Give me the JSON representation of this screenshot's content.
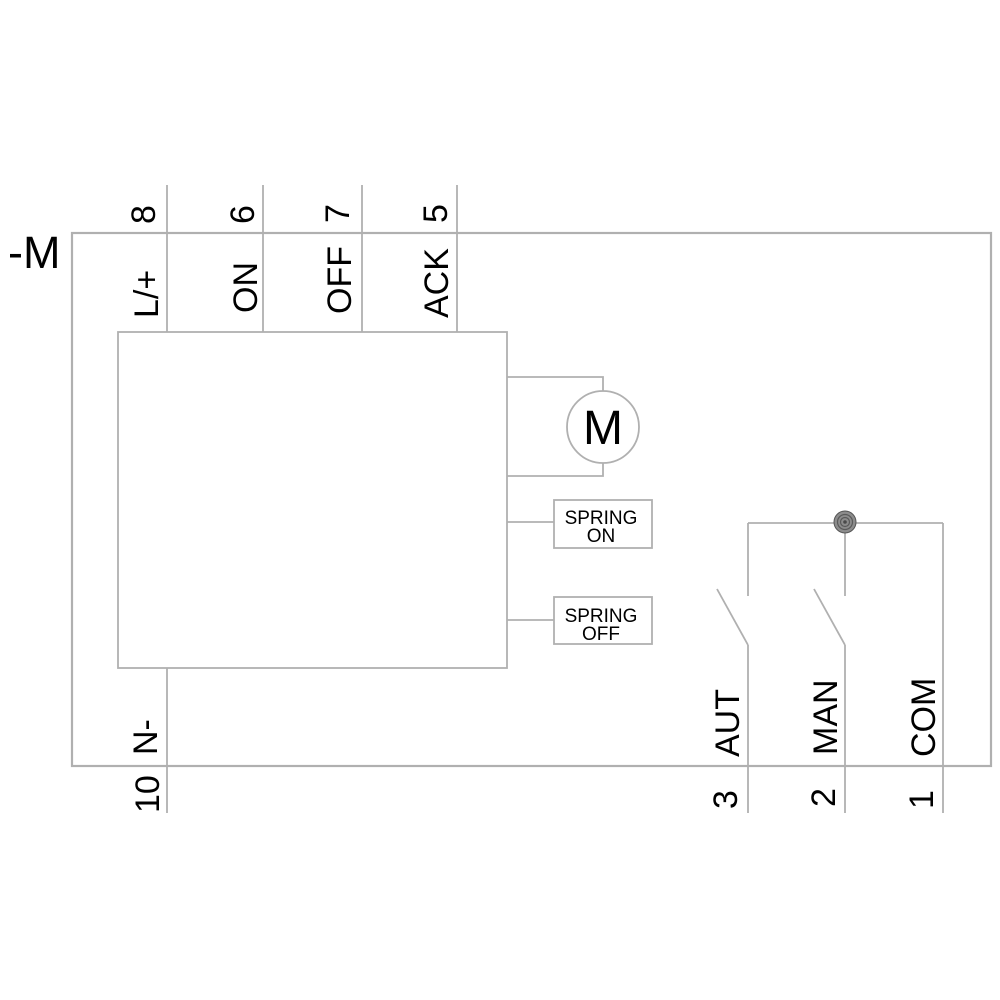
{
  "device_label": "-M",
  "motor": {
    "label": "M"
  },
  "top_terminals": [
    {
      "number": "8",
      "label": "L/+"
    },
    {
      "number": "6",
      "label": "ON"
    },
    {
      "number": "7",
      "label": "OFF"
    },
    {
      "number": "5",
      "label": "ACK"
    }
  ],
  "bottom_terminal": {
    "number": "10",
    "label": "N-"
  },
  "spring_on": {
    "line1": "SPRING",
    "line2": "ON"
  },
  "spring_off": {
    "line1": "SPRING",
    "line2": "OFF"
  },
  "selector_terminals": [
    {
      "number": "3",
      "label": "AUT"
    },
    {
      "number": "2",
      "label": "MAN"
    },
    {
      "number": "1",
      "label": "COM"
    }
  ],
  "colors": {
    "wire": "#b0b0b0",
    "text": "#000000",
    "junction_dot": "#8c8c8c",
    "background": "#ffffff"
  }
}
